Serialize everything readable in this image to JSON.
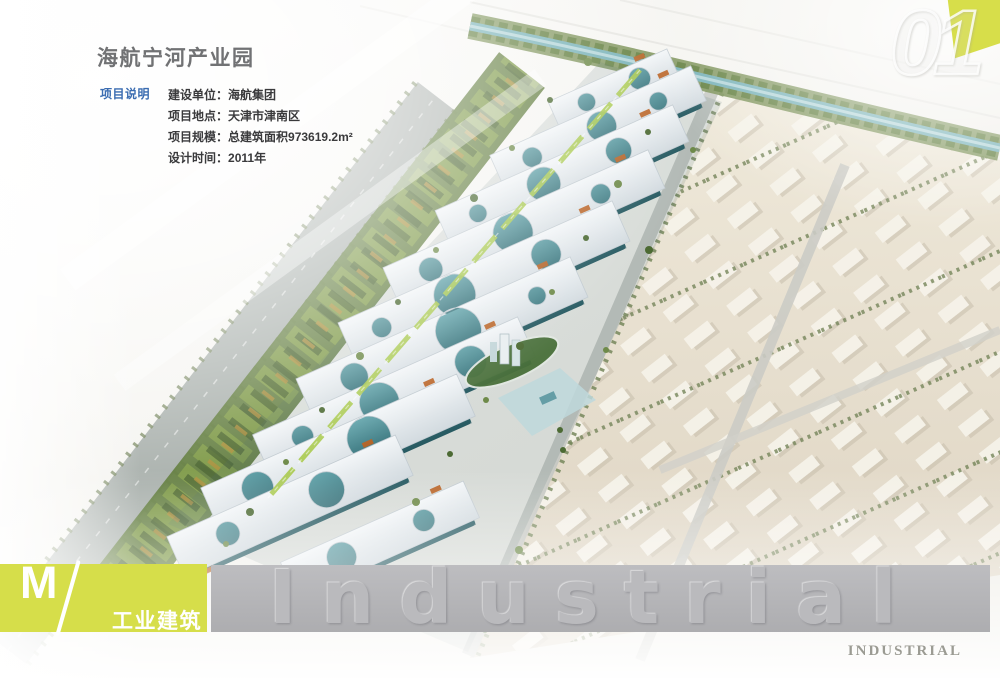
{
  "header": {
    "title": "海航宁河产业园",
    "info_label": "项目说明",
    "info": [
      {
        "key": "建设单位：",
        "value": "海航集团"
      },
      {
        "key": "项目地点：",
        "value": "天津市津南区"
      },
      {
        "key": "项目规模：",
        "value": "总建筑面积973619.2m²"
      },
      {
        "key": "设计时间：",
        "value": "2011年"
      }
    ]
  },
  "corner": {
    "number": "01"
  },
  "footer": {
    "category_letter": "M",
    "category_label": "工业建筑",
    "watermark_word": "Industrial",
    "watermark_caps": "INDUSTRIAL"
  },
  "rendering": {
    "description": "Aerial rendering: white perforated canopy factory buildings along a green riverside belt, with a beige warehouse district of white sheds on the right"
  },
  "colors": {
    "accent_yellow": "#d7de4a",
    "label_blue": "#3a6cb1",
    "band_gray": "#b5b5b8",
    "canopy_white": "#e9eef1",
    "teal_building": "#4e8f98",
    "warehouse_beige": "#e5ddcc"
  }
}
